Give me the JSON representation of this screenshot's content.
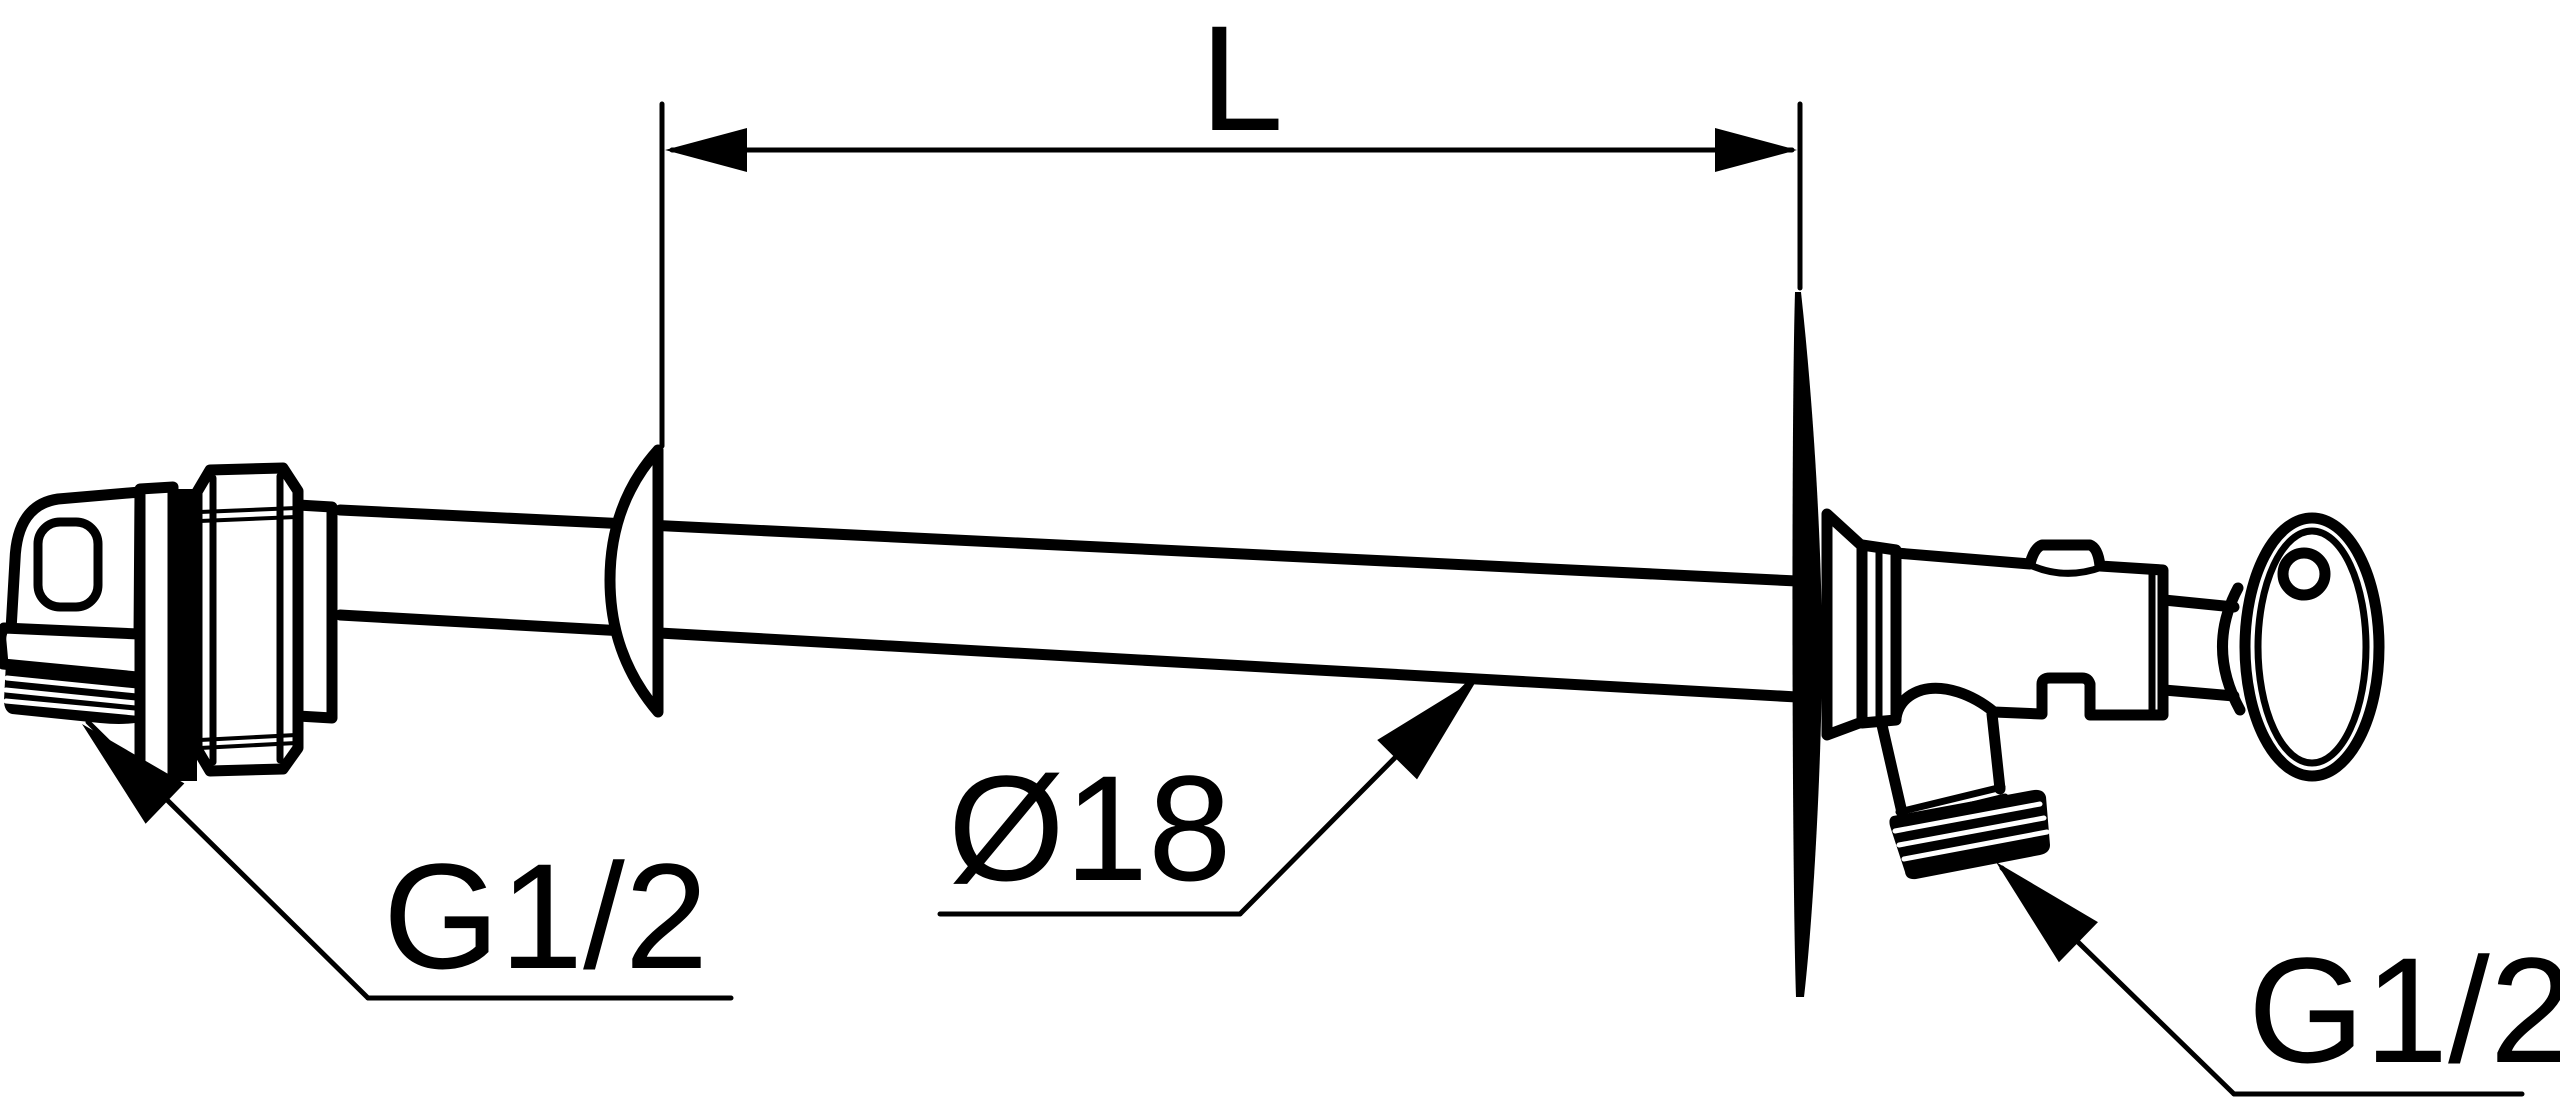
{
  "drawing": {
    "kind": "technical-line-drawing",
    "labels": {
      "length_dimension": "L",
      "pipe_diameter": "Ø18",
      "inlet_thread": "G1/2",
      "outlet_thread": "G1/2"
    },
    "colors": {
      "line": "#000000",
      "background": "#ffffff"
    }
  }
}
